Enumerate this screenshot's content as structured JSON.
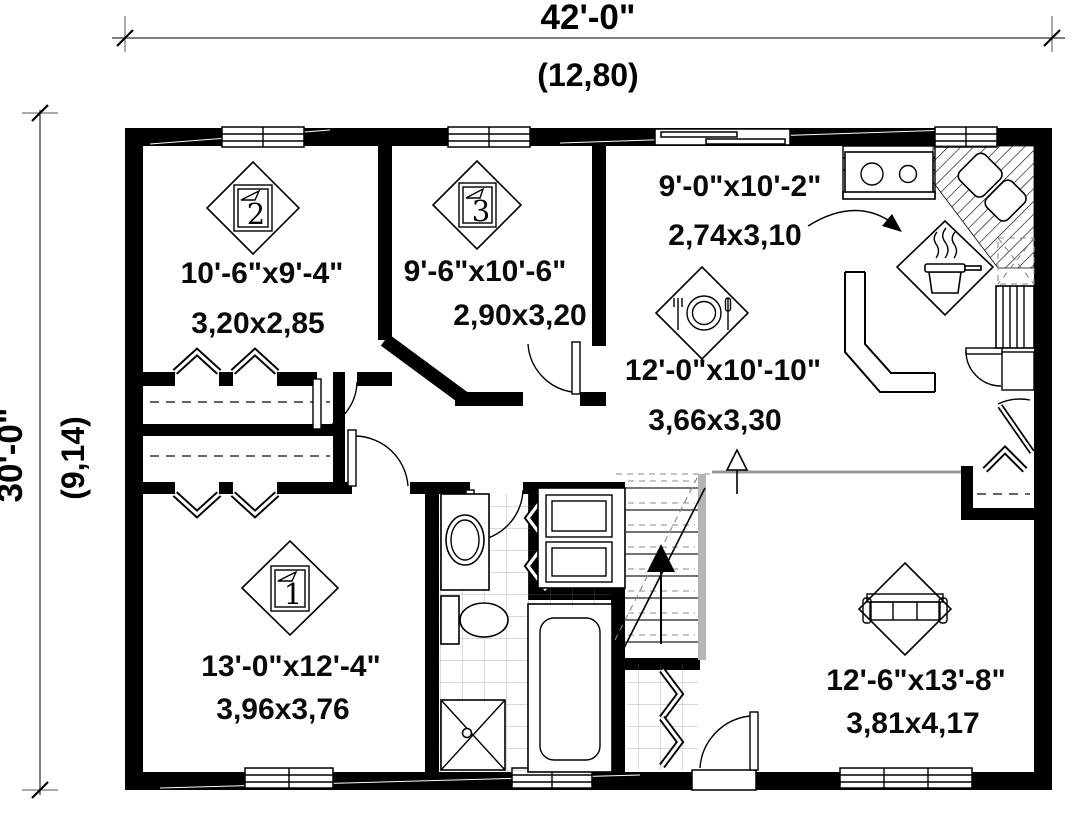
{
  "title": "Single storey house floor plan",
  "dimensions": {
    "width_imperial": "42'-0\"",
    "width_metric": "(12,80)",
    "height_imperial": "30'-0\"",
    "height_metric": "(9,14)"
  },
  "rooms": {
    "bedroom2": {
      "badge": "2",
      "size_imperial": "10'-6\"x9'-4\"",
      "size_metric": "3,20x2,85"
    },
    "bedroom3": {
      "badge": "3",
      "size_imperial": "9'-6\"x10'-6\"",
      "size_metric": "2,90x3,20"
    },
    "kitchen": {
      "size_imperial": "9'-0\"x10'-2\"",
      "size_metric": "2,74x3,10"
    },
    "dining": {
      "size_imperial": "12'-0\"x10'-10\"",
      "size_metric": "3,66x3,30"
    },
    "bedroom1": {
      "badge": "1",
      "size_imperial": "13'-0\"x12'-4\"",
      "size_metric": "3,96x3,76"
    },
    "living": {
      "size_imperial": "12'-6\"x13'-8\"",
      "size_metric": "3,81x4,17"
    }
  },
  "icons": {
    "bedroom_badge": "numbered-bed-tag",
    "kitchen": "cooking-pot-with-steam",
    "dining": "place-setting-plate-fork-knife",
    "living": "three-seat-sofa",
    "stairs": "up-direction-arrow"
  },
  "colors": {
    "ink": "#000000",
    "paper": "#ffffff",
    "stair_gray": "#b5b5b5",
    "tile_gray": "#888888"
  }
}
